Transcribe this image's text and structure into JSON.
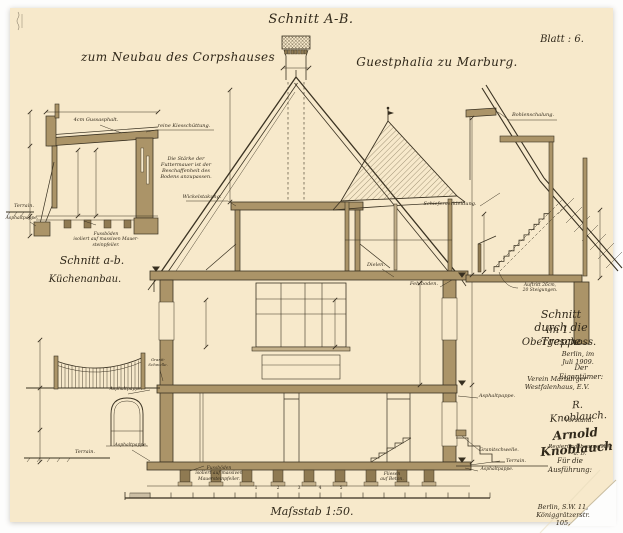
{
  "page": {
    "paper_color": "#f7e9cb",
    "ink_color": "#352d1f",
    "wall_fill": "#ab9468"
  },
  "header": {
    "title": "Schnitt A-B.",
    "subtitle_left": "zum Neubau des Corpshauses",
    "subtitle_right": "Guestphalia zu Marburg.",
    "sheet_label": "Blatt : 6."
  },
  "kitchen_inset": {
    "caption_line1": "Schnitt a-b.",
    "caption_line2": "Küchenanbau.",
    "label_gussasphalt": "4cm Gussasphalt.",
    "label_kies": "reine Kiesschüttung.",
    "note_futtermauer": "Die Stärke der\nFuttermauer ist der\nBeschaffenheit des\nBodens anzupassen.",
    "label_terrain": "Terrain.",
    "label_asphaltpappe": "Asphaltpappe.",
    "note_fussboeden": "Fussböden\nisoliert auf massiven Mauer-\nsteinpfeiler."
  },
  "stair_inset": {
    "caption_line1": "Schnitt durch die Treppe",
    "caption_line2": "im 1. Obergeschoss.",
    "label_bohlenschalung": "Bohlenschalung.",
    "label_schiefer": "Schieferverkleidung.",
    "note_auftritt": "Auftritt 26cm,\n20 Steigungen."
  },
  "main_section": {
    "label_wickelstakung": "Wickelstakung.",
    "label_dielen": "Dielen.",
    "label_fehlboden": "Fehlboden.",
    "label_asphaltpappe_upper_left": "Asphaltpappe.",
    "label_granitschwelle_left": "Granit-\nSchwelle.",
    "label_asphaltpappe_lower_left": "Asphaltpappe.",
    "label_terrain_left": "Terrain.",
    "note_fussboeden": "Fussböden\nisoliert auf massiven\nMauersteinpfeiler.",
    "label_fliesen": "Fliesen\nauf Beton.",
    "label_asphaltpappe_right": "Asphaltpappe.",
    "label_granitschwelle_right": "Granitschwelle.",
    "label_terrain_right": "Terrain.",
    "label_asphaltpappe_lower_right": "Asphaltpappe."
  },
  "footer": {
    "scale_text": "Maſsstab 1:50.",
    "scalebar_numbers": [
      "1",
      "2",
      "3",
      "4",
      "5"
    ],
    "date_line": "Berlin, im Juli 1909.",
    "owner_heading": "Der Eigentümer:",
    "owner_name": "Verein Marburger Westfalenhaus, E.V.",
    "signature_1": "R. Knoblauch.",
    "signature_1_role": "Vorstand.",
    "signature_2": "Arnold Knoblauch",
    "signature_2_role": "Regierungsbaumeister a. D.",
    "execution_line": "Für die Ausführung:",
    "address_line": "Berlin, S.W. 11, Königgrätzerstr. 105."
  }
}
